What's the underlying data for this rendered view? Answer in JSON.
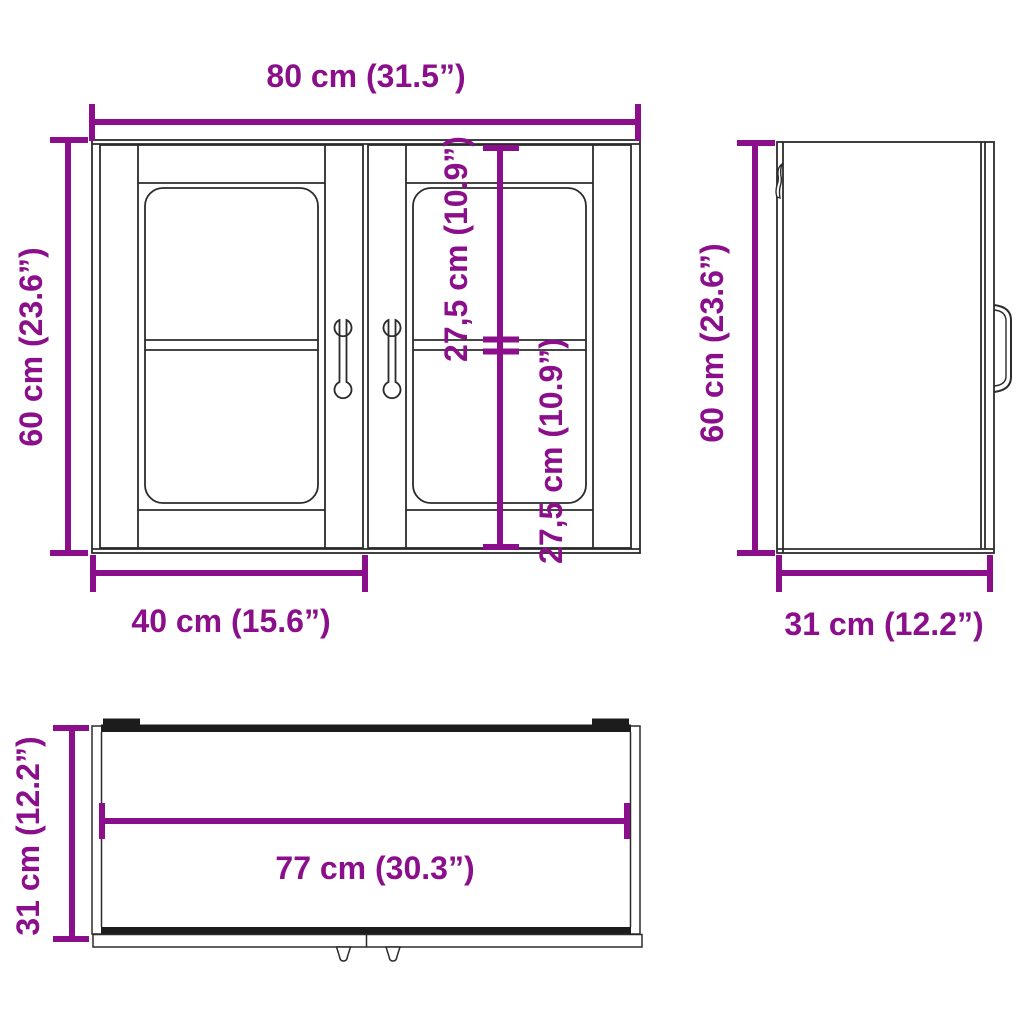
{
  "title": "Wall cabinet with glass doors - dimension drawing",
  "colors": {
    "dimension": "#8B0F8B",
    "line": "#2B2B2B",
    "background": "#FFFFFF"
  },
  "views": {
    "front": {
      "overall_width_label": "80 cm (31.5”)",
      "overall_height_label": "60 cm (23.6”)",
      "door_width_label": "40 cm (15.6”)",
      "upper_compartment_label": "27,5 cm (10.9”)",
      "lower_compartment_label": "27,5 cm (10.9”)"
    },
    "side": {
      "height_label": "60 cm (23.6”)",
      "depth_label": "31 cm (12.2”)"
    },
    "top": {
      "inner_width_label": "77 cm (30.3”)",
      "depth_label": "31 cm (12.2”)"
    }
  }
}
